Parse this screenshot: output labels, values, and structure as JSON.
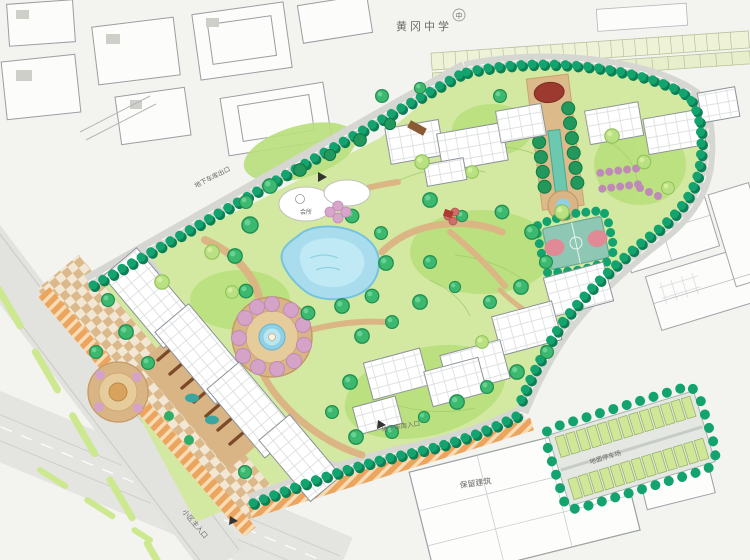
{
  "map": {
    "title": "residential-landscape-master-plan",
    "labels": {
      "school": "黄冈中学",
      "school_badge": "中",
      "garage_exit": "地下车库出口",
      "garage_entrance": "地下车库入口",
      "retained_building": "保留建筑",
      "surface_parking": "地面停车场",
      "street": "小区主入口",
      "clubhouse": "会所"
    },
    "colors": {
      "paper": "#f3f3ef",
      "lawn": "#d3e9a2",
      "lawn_mound": "#b9e07c",
      "tree_bright": "#3cb96f",
      "tree_dark": "#22985c",
      "tree_light": "#b9e183",
      "hedge": "#12a36e",
      "water": "#a9ddee",
      "pool_edge": "#77c3dc",
      "path_tan": "#d9b586",
      "road": "#d6d6d3",
      "flower_pink": "#d5a3c8",
      "pergola_brown": "#7c4a28",
      "commercial_hatch": "#eca55e",
      "court_teal": "#8ec7b4",
      "court_key_pink": "#e08a96",
      "axis_maroon": "#9c3a30",
      "parking_stall": "#cfe796",
      "building_fill": "#ffffff",
      "building_line": "#8b9095"
    }
  }
}
